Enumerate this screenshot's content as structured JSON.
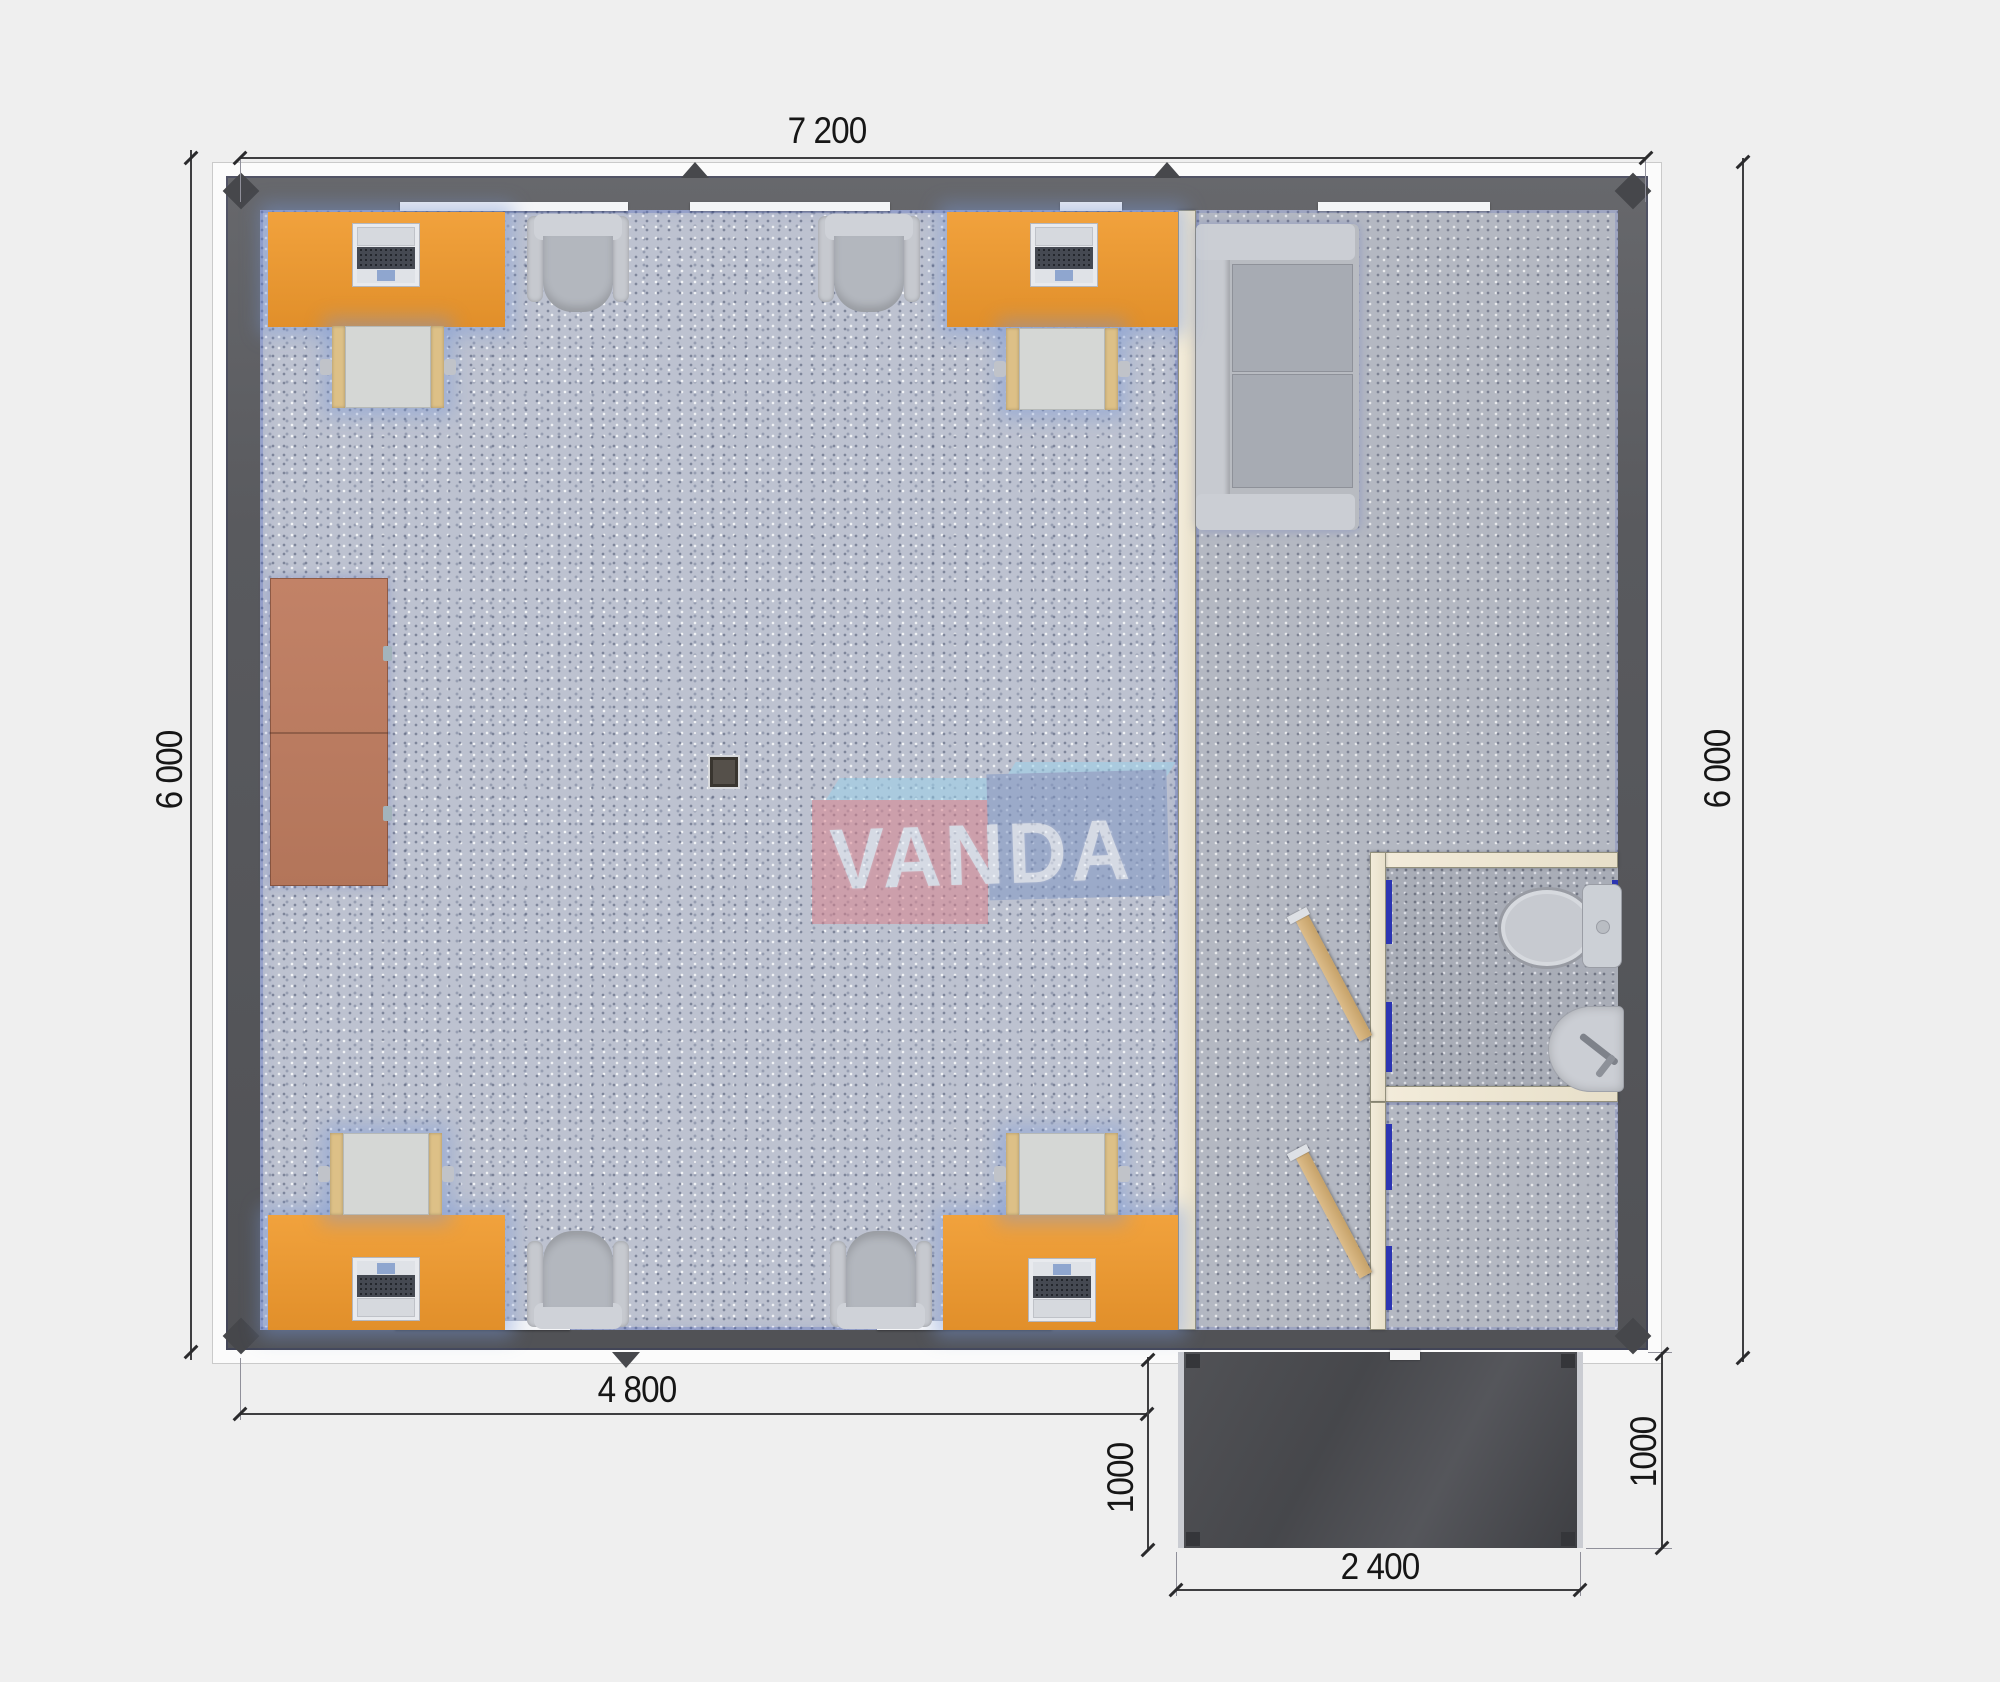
{
  "brand": {
    "name": "VANDA",
    "panel_left_color": "#d9838e",
    "panel_right_color": "#8197c4",
    "band_color": "#9cd1ea",
    "text_color": "#e9eef6"
  },
  "dimensions": {
    "top_width": "7 200",
    "left_height": "6 000",
    "right_height": "6 000",
    "office_width": "4 800",
    "porch_depth_left": "1000",
    "porch_depth_right": "1000",
    "porch_width": "2 400"
  },
  "palette": {
    "wall": "#595a5e",
    "fascia": "#fbfbfb",
    "partition_beige": "#ece5d2",
    "door_frame_blue": "#2c35b2",
    "door_wood": "#d2b183",
    "desk_orange": "#ea9734",
    "cabinet_brown": "#bb7a5e",
    "furniture_gray": "#c2c5cb",
    "office_carpet": "#bdc2d0",
    "hall_carpet": "#b4b8c2",
    "bath_floor": "#a9adb7",
    "porch_deck": "#4b4c4f"
  },
  "fixtures": {
    "office": [
      "desk-with-laptop x4",
      "task-table-with-chair x4",
      "armchair x4",
      "storage-cabinet",
      "column"
    ],
    "lounge": [
      "sofa"
    ],
    "bathroom": [
      "toilet",
      "wash-basin"
    ],
    "doors": [
      "bathroom-door-open",
      "vestibule-door-open"
    ],
    "porch": [
      "entry-deck",
      "door-mat"
    ]
  }
}
